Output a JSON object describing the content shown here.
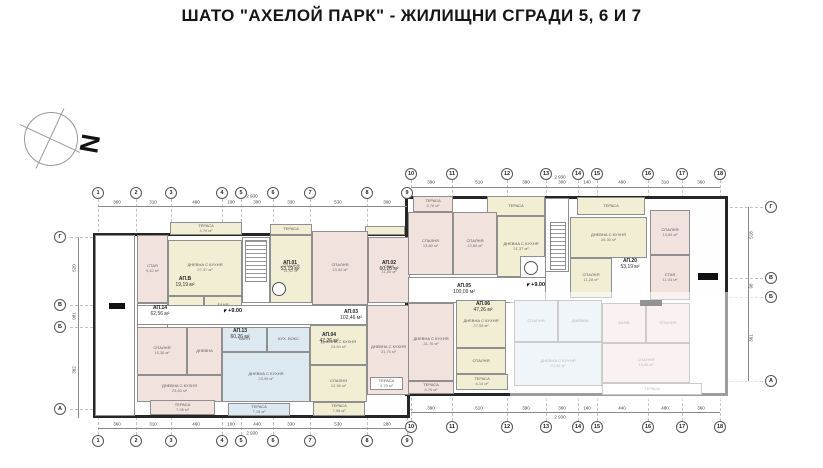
{
  "title": "ШАТО  \"АХЕЛОЙ ПАРК\" -  ЖИЛИЩНИ СГРАДИ 5, 6 И 7",
  "north_label": "N",
  "colors": {
    "wall": "#262626",
    "cream": "#f2eed4",
    "pink": "#f1e2de",
    "blue": "#dde9f1",
    "grid": "#c2c2c2"
  },
  "grid": {
    "top_bubbles": [
      {
        "n": "1",
        "x": 98,
        "y": 193
      },
      {
        "n": "2",
        "x": 136,
        "y": 193
      },
      {
        "n": "3",
        "x": 171,
        "y": 193
      },
      {
        "n": "4",
        "x": 222,
        "y": 193
      },
      {
        "n": "5",
        "x": 241,
        "y": 193
      },
      {
        "n": "6",
        "x": 273,
        "y": 193
      },
      {
        "n": "7",
        "x": 310,
        "y": 193
      },
      {
        "n": "8",
        "x": 367,
        "y": 193
      },
      {
        "n": "9",
        "x": 407,
        "y": 193
      },
      {
        "n": "10",
        "x": 411,
        "y": 174
      },
      {
        "n": "11",
        "x": 452,
        "y": 174
      },
      {
        "n": "12",
        "x": 507,
        "y": 174
      },
      {
        "n": "13",
        "x": 546,
        "y": 174
      },
      {
        "n": "14",
        "x": 578,
        "y": 174
      },
      {
        "n": "15",
        "x": 597,
        "y": 174
      },
      {
        "n": "16",
        "x": 648,
        "y": 174
      },
      {
        "n": "17",
        "x": 682,
        "y": 174
      },
      {
        "n": "18",
        "x": 720,
        "y": 174
      }
    ],
    "bottom_bubbles": [
      {
        "n": "1",
        "x": 98,
        "y": 441
      },
      {
        "n": "2",
        "x": 136,
        "y": 441
      },
      {
        "n": "3",
        "x": 171,
        "y": 441
      },
      {
        "n": "4",
        "x": 222,
        "y": 441
      },
      {
        "n": "5",
        "x": 241,
        "y": 441
      },
      {
        "n": "6",
        "x": 273,
        "y": 441
      },
      {
        "n": "7",
        "x": 310,
        "y": 441
      },
      {
        "n": "8",
        "x": 367,
        "y": 441
      },
      {
        "n": "9",
        "x": 407,
        "y": 441
      },
      {
        "n": "10",
        "x": 411,
        "y": 427
      },
      {
        "n": "11",
        "x": 452,
        "y": 427
      },
      {
        "n": "12",
        "x": 507,
        "y": 427
      },
      {
        "n": "13",
        "x": 546,
        "y": 427
      },
      {
        "n": "14",
        "x": 578,
        "y": 427
      },
      {
        "n": "15",
        "x": 597,
        "y": 427
      },
      {
        "n": "16",
        "x": 648,
        "y": 427
      },
      {
        "n": "17",
        "x": 682,
        "y": 427
      },
      {
        "n": "18",
        "x": 720,
        "y": 427
      }
    ],
    "left_letters": [
      {
        "l": "Г",
        "x": 60,
        "y": 237,
        "side": "left"
      },
      {
        "l": "В",
        "x": 60,
        "y": 305,
        "side": "left"
      },
      {
        "l": "Б",
        "x": 60,
        "y": 327,
        "side": "left"
      },
      {
        "l": "А",
        "x": 60,
        "y": 409,
        "side": "left"
      }
    ],
    "right_letters": [
      {
        "l": "Г",
        "x": 771,
        "y": 207,
        "side": "right"
      },
      {
        "l": "В",
        "x": 771,
        "y": 278,
        "side": "right"
      },
      {
        "l": "Б",
        "x": 771,
        "y": 297,
        "side": "right"
      },
      {
        "l": "А",
        "x": 771,
        "y": 381,
        "side": "right"
      }
    ]
  },
  "plan": {
    "buildings": [
      {
        "x": 93,
        "y": 233,
        "w": 317,
        "h": 185
      },
      {
        "x": 405,
        "y": 196,
        "w": 323,
        "h": 200
      }
    ],
    "rooms": [
      {
        "x": 95,
        "y": 235,
        "w": 40,
        "h": 181,
        "f": "white",
        "l": "",
        "a": ""
      },
      {
        "x": 170,
        "y": 222,
        "w": 72,
        "h": 13,
        "f": "cream",
        "l": "ТЕРАСА",
        "a": "4,79 м²"
      },
      {
        "x": 270,
        "y": 224,
        "w": 42,
        "h": 11,
        "f": "cream",
        "l": "ТЕРАСА",
        "a": ""
      },
      {
        "x": 365,
        "y": 226,
        "w": 40,
        "h": 9,
        "f": "cream",
        "l": "",
        "a": ""
      },
      {
        "x": 137,
        "y": 235,
        "w": 31,
        "h": 68,
        "f": "pink",
        "l": "СТАЯ",
        "a": "9,42 м²"
      },
      {
        "x": 168,
        "y": 240,
        "w": 74,
        "h": 56,
        "f": "cream",
        "l": "ДНЕВНА С КУХНЯ",
        "a": "27,37 м²"
      },
      {
        "x": 168,
        "y": 296,
        "w": 36,
        "h": 24,
        "f": "cream",
        "l": "",
        "a": ""
      },
      {
        "x": 204,
        "y": 296,
        "w": 38,
        "h": 24,
        "f": "cream",
        "l": "БАНЯ",
        "a": "4,06 м²"
      },
      {
        "x": 137,
        "y": 303,
        "w": 31,
        "h": 40,
        "f": "white",
        "l": "АНТРЕ",
        "a": ""
      },
      {
        "x": 242,
        "y": 237,
        "w": 28,
        "h": 66,
        "f": "white",
        "l": "",
        "a": ""
      },
      {
        "x": 270,
        "y": 235,
        "w": 42,
        "h": 68,
        "f": "cream",
        "l": "СПАЛНЯ",
        "a": "11,42 м²"
      },
      {
        "x": 312,
        "y": 231,
        "w": 56,
        "h": 74,
        "f": "pink",
        "l": "СПАЛНЯ",
        "a": "13,42 м²"
      },
      {
        "x": 368,
        "y": 237,
        "w": 42,
        "h": 66,
        "f": "pink",
        "l": "СТАЯ",
        "a": "11,86 м²"
      },
      {
        "x": 137,
        "y": 305,
        "w": 230,
        "h": 20,
        "f": "white",
        "l": "",
        "a": ""
      },
      {
        "x": 137,
        "y": 327,
        "w": 50,
        "h": 48,
        "f": "pink",
        "l": "СПАЛНЯ",
        "a": "15,36 м²"
      },
      {
        "x": 187,
        "y": 327,
        "w": 35,
        "h": 48,
        "f": "pink",
        "l": "ДНЕВНА",
        "a": ""
      },
      {
        "x": 137,
        "y": 375,
        "w": 85,
        "h": 27,
        "f": "pink",
        "l": "ДНЕВНА С КУХНЯ",
        "a": "23,63 м²"
      },
      {
        "x": 222,
        "y": 327,
        "w": 45,
        "h": 25,
        "f": "blue",
        "l": "БАНЯ",
        "a": ""
      },
      {
        "x": 267,
        "y": 327,
        "w": 43,
        "h": 25,
        "f": "blue",
        "l": "КУХ. БОКС",
        "a": ""
      },
      {
        "x": 222,
        "y": 352,
        "w": 88,
        "h": 50,
        "f": "blue",
        "l": "ДНЕВНА С КУХНЯ",
        "a": "23,95 м²"
      },
      {
        "x": 310,
        "y": 325,
        "w": 57,
        "h": 40,
        "f": "cream",
        "l": "ДНЕВНА С КУХНЯ",
        "a": "24,64 м²"
      },
      {
        "x": 310,
        "y": 365,
        "w": 57,
        "h": 37,
        "f": "cream",
        "l": "СПАЛНЯ",
        "a": "12,96 м²"
      },
      {
        "x": 367,
        "y": 305,
        "w": 43,
        "h": 90,
        "f": "pink",
        "l": "ДНЕВНА С КУХНЯ",
        "a": "31,76 м²"
      },
      {
        "x": 150,
        "y": 400,
        "w": 65,
        "h": 15,
        "f": "pink",
        "l": "ТЕРАСА",
        "a": "7,98 м²"
      },
      {
        "x": 228,
        "y": 403,
        "w": 62,
        "h": 13,
        "f": "blue",
        "l": "ТЕРАСА",
        "a": "7,18 м²"
      },
      {
        "x": 313,
        "y": 402,
        "w": 52,
        "h": 14,
        "f": "cream",
        "l": "ТЕРАСА",
        "a": "7,98 м²"
      },
      {
        "x": 370,
        "y": 377,
        "w": 33,
        "h": 13,
        "f": "white",
        "l": "ТЕРАСА",
        "a": "4,79 м²"
      },
      {
        "x": 413,
        "y": 196,
        "w": 40,
        "h": 16,
        "f": "pink",
        "l": "ТЕРАСА",
        "a": "6,76 м²"
      },
      {
        "x": 487,
        "y": 196,
        "w": 58,
        "h": 20,
        "f": "cream",
        "l": "ТЕРАСА",
        "a": ""
      },
      {
        "x": 577,
        "y": 197,
        "w": 68,
        "h": 18,
        "f": "cream",
        "l": "ТЕРАСА",
        "a": ""
      },
      {
        "x": 408,
        "y": 212,
        "w": 45,
        "h": 63,
        "f": "pink",
        "l": "СПАЛНЯ",
        "a": "13,80 м²"
      },
      {
        "x": 453,
        "y": 212,
        "w": 44,
        "h": 63,
        "f": "pink",
        "l": "СПАЛНЯ",
        "a": "12,65 м²"
      },
      {
        "x": 497,
        "y": 216,
        "w": 48,
        "h": 61,
        "f": "cream",
        "l": "ДНЕВНА С КУХНЯ",
        "a": "21,37 м²"
      },
      {
        "x": 545,
        "y": 198,
        "w": 24,
        "h": 74,
        "f": "white",
        "l": "",
        "a": ""
      },
      {
        "x": 570,
        "y": 217,
        "w": 77,
        "h": 41,
        "f": "cream",
        "l": "ДНЕВНА С КУХНЯ",
        "a": "26,30 м²"
      },
      {
        "x": 650,
        "y": 210,
        "w": 40,
        "h": 45,
        "f": "pink",
        "l": "СПАЛНЯ",
        "a": "13,84 м²"
      },
      {
        "x": 650,
        "y": 255,
        "w": 40,
        "h": 45,
        "f": "pink",
        "l": "СТАЯ",
        "a": "11,04 м²"
      },
      {
        "x": 570,
        "y": 258,
        "w": 42,
        "h": 40,
        "f": "cream",
        "l": "СПАЛНЯ",
        "a": "11,28 м²"
      },
      {
        "x": 520,
        "y": 256,
        "w": 26,
        "h": 30,
        "f": "white",
        "l": "",
        "a": ""
      },
      {
        "x": 408,
        "y": 277,
        "w": 138,
        "h": 26,
        "f": "white",
        "l": "",
        "a": ""
      },
      {
        "x": 408,
        "y": 303,
        "w": 46,
        "h": 78,
        "f": "pink",
        "l": "ДНЕВНА С КУХНЯ",
        "a": "31,76 м²"
      },
      {
        "x": 408,
        "y": 381,
        "w": 46,
        "h": 13,
        "f": "pink",
        "l": "ТЕРАСА",
        "a": "6,76 м²"
      },
      {
        "x": 456,
        "y": 300,
        "w": 50,
        "h": 48,
        "f": "cream",
        "l": "ДНЕВНА С КУХНЯ",
        "a": "27,55 м²"
      },
      {
        "x": 456,
        "y": 348,
        "w": 50,
        "h": 26,
        "f": "cream",
        "l": "СПАЛНЯ",
        "a": ""
      },
      {
        "x": 456,
        "y": 374,
        "w": 52,
        "h": 16,
        "f": "cream",
        "l": "ТЕРАСА",
        "a": "6,14 м²"
      },
      {
        "x": 514,
        "y": 300,
        "w": 44,
        "h": 42,
        "f": "blue",
        "l": "СПАЛНЯ",
        "a": ""
      },
      {
        "x": 558,
        "y": 300,
        "w": 44,
        "h": 42,
        "f": "blue",
        "l": "ДНЕВНА",
        "a": ""
      },
      {
        "x": 514,
        "y": 342,
        "w": 88,
        "h": 44,
        "f": "blue",
        "l": "ДНЕВНА С КУХНЯ",
        "a": "23,95 м²"
      },
      {
        "x": 602,
        "y": 303,
        "w": 44,
        "h": 40,
        "f": "pink",
        "l": "БАНЯ",
        "a": ""
      },
      {
        "x": 646,
        "y": 303,
        "w": 44,
        "h": 40,
        "f": "pink",
        "l": "СПАЛНЯ",
        "a": ""
      },
      {
        "x": 602,
        "y": 343,
        "w": 88,
        "h": 40,
        "f": "pink",
        "l": "СПАЛНЯ",
        "a": "18,86 м²"
      },
      {
        "x": 602,
        "y": 383,
        "w": 100,
        "h": 12,
        "f": "white",
        "l": "ТЕРАСА",
        "a": ""
      }
    ],
    "stairs": [
      {
        "x": 245,
        "y": 240,
        "w": 22,
        "h": 42
      },
      {
        "x": 550,
        "y": 222,
        "w": 16,
        "h": 48
      }
    ],
    "elevators": [
      {
        "x": 272,
        "y": 282,
        "d": 14
      },
      {
        "x": 524,
        "y": 261,
        "d": 14
      }
    ],
    "black_bars": [
      {
        "x": 109,
        "y": 303,
        "w": 16,
        "h": 6
      },
      {
        "x": 698,
        "y": 273,
        "w": 20,
        "h": 7
      },
      {
        "x": 640,
        "y": 300,
        "w": 22,
        "h": 6
      }
    ],
    "overlay": {
      "x": 510,
      "y": 292,
      "w": 252,
      "h": 108
    },
    "apt_labels": [
      {
        "x": 185,
        "y": 282,
        "n": "АП.В",
        "a": "19,19 м²"
      },
      {
        "x": 290,
        "y": 266,
        "n": "АП.01",
        "a": "53,19 м²"
      },
      {
        "x": 389,
        "y": 266,
        "n": "АП.02",
        "a": "60,26 м²"
      },
      {
        "x": 160,
        "y": 311,
        "n": "АП.14",
        "a": "62,56 м²"
      },
      {
        "x": 240,
        "y": 334,
        "n": "АП.13",
        "a": "60,26 м²"
      },
      {
        "x": 351,
        "y": 315,
        "n": "АП.03",
        "a": "102,46 м²"
      },
      {
        "x": 329,
        "y": 338,
        "n": "АП.04",
        "a": "47,26 м²"
      },
      {
        "x": 464,
        "y": 289,
        "n": "АП.05",
        "a": "100,09 м²"
      },
      {
        "x": 483,
        "y": 307,
        "n": "АП.06",
        "a": "47,26 м²"
      },
      {
        "x": 630,
        "y": 264,
        "n": "АП.20",
        "a": "53,19 м²"
      }
    ],
    "level_marks": [
      {
        "x": 233,
        "y": 311,
        "t": "+9.00"
      },
      {
        "x": 536,
        "y": 285,
        "t": "+9.00"
      }
    ]
  },
  "dims": {
    "lines": [
      {
        "x": 98,
        "y": 206,
        "w": 309
      },
      {
        "x": 411,
        "y": 187,
        "w": 309
      },
      {
        "x": 98,
        "y": 428,
        "w": 309
      },
      {
        "x": 411,
        "y": 412,
        "w": 309
      }
    ],
    "vlines": [
      {
        "x": 78,
        "y": 237,
        "h": 181
      },
      {
        "x": 748,
        "y": 207,
        "h": 174
      }
    ],
    "labels": [
      {
        "x": 117,
        "y": 202,
        "t": "360"
      },
      {
        "x": 153,
        "y": 202,
        "t": "310"
      },
      {
        "x": 196,
        "y": 202,
        "t": "460"
      },
      {
        "x": 231,
        "y": 202,
        "t": "100"
      },
      {
        "x": 257,
        "y": 202,
        "t": "300"
      },
      {
        "x": 291,
        "y": 202,
        "t": "330"
      },
      {
        "x": 338,
        "y": 202,
        "t": "530"
      },
      {
        "x": 387,
        "y": 202,
        "t": "300"
      },
      {
        "x": 431,
        "y": 182,
        "t": "390"
      },
      {
        "x": 479,
        "y": 182,
        "t": "510"
      },
      {
        "x": 526,
        "y": 182,
        "t": "390"
      },
      {
        "x": 562,
        "y": 182,
        "t": "300"
      },
      {
        "x": 587,
        "y": 182,
        "t": "140"
      },
      {
        "x": 622,
        "y": 182,
        "t": "490"
      },
      {
        "x": 665,
        "y": 182,
        "t": "310"
      },
      {
        "x": 701,
        "y": 182,
        "t": "360"
      },
      {
        "x": 117,
        "y": 424,
        "t": "360"
      },
      {
        "x": 153,
        "y": 424,
        "t": "310"
      },
      {
        "x": 196,
        "y": 424,
        "t": "460"
      },
      {
        "x": 231,
        "y": 424,
        "t": "100"
      },
      {
        "x": 257,
        "y": 424,
        "t": "440"
      },
      {
        "x": 291,
        "y": 424,
        "t": "330"
      },
      {
        "x": 338,
        "y": 424,
        "t": "530"
      },
      {
        "x": 387,
        "y": 424,
        "t": "280"
      },
      {
        "x": 431,
        "y": 408,
        "t": "390"
      },
      {
        "x": 479,
        "y": 408,
        "t": "510"
      },
      {
        "x": 526,
        "y": 408,
        "t": "390"
      },
      {
        "x": 562,
        "y": 408,
        "t": "300"
      },
      {
        "x": 587,
        "y": 408,
        "t": "140"
      },
      {
        "x": 622,
        "y": 408,
        "t": "440"
      },
      {
        "x": 665,
        "y": 408,
        "t": "480"
      },
      {
        "x": 701,
        "y": 408,
        "t": "360"
      },
      {
        "x": 252,
        "y": 196,
        "t": "2 930"
      },
      {
        "x": 560,
        "y": 177,
        "t": "2 930"
      },
      {
        "x": 252,
        "y": 433,
        "t": "2 930"
      },
      {
        "x": 560,
        "y": 417,
        "t": "2 930"
      }
    ],
    "vertical_labels": [
      {
        "x": 74,
        "y": 268,
        "t": "520"
      },
      {
        "x": 74,
        "y": 316,
        "t": "981"
      },
      {
        "x": 74,
        "y": 370,
        "t": "382"
      },
      {
        "x": 751,
        "y": 235,
        "t": "518"
      },
      {
        "x": 751,
        "y": 286,
        "t": "98"
      },
      {
        "x": 751,
        "y": 338,
        "t": "361"
      }
    ]
  }
}
